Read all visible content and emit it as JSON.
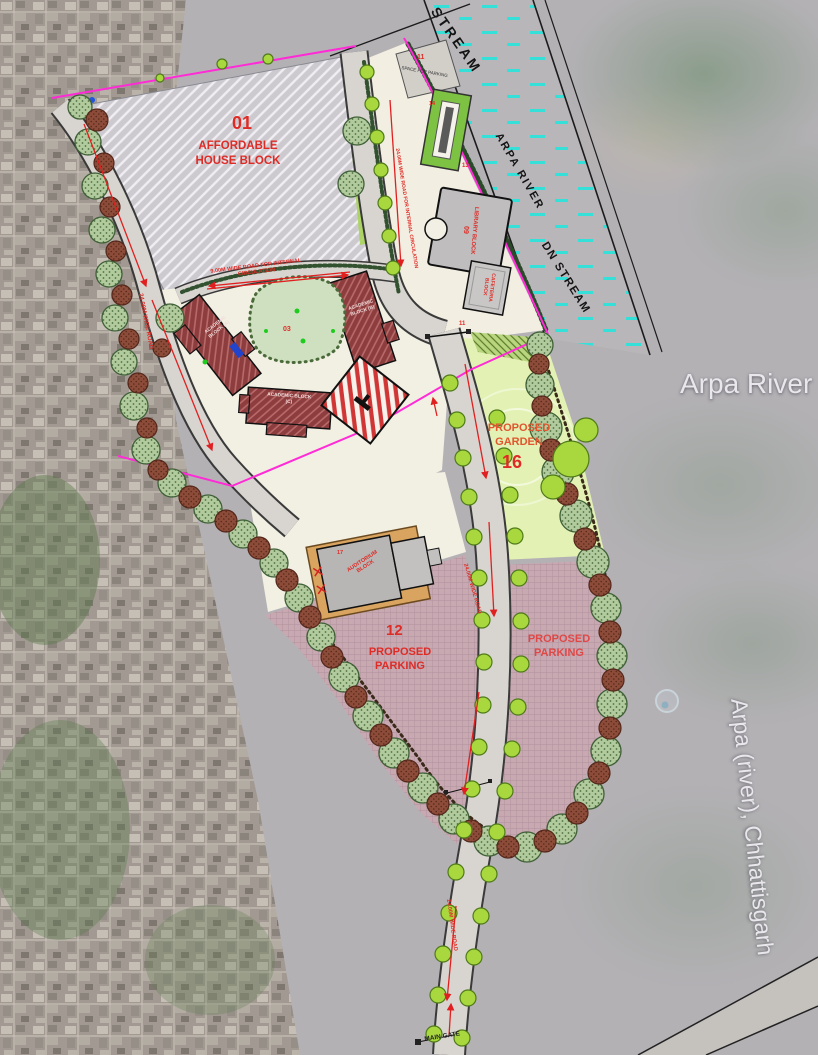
{
  "water": {
    "up_stream": "STREAM",
    "arpa_river": "ARPA RIVER",
    "dn_stream": "DN STREAM"
  },
  "map": {
    "river_name": "Arpa River",
    "river_full_name": "Arpa (river), Chhattisgarh"
  },
  "zones": {
    "affordable": {
      "number": "01",
      "label": "AFFORDABLE HOUSE BLOCK"
    },
    "space_for_parking": {
      "number": "11",
      "label": "SPACE FOR PARKING"
    },
    "plaza": {
      "number": "13"
    },
    "pool": {
      "number": "14"
    },
    "courtyard": {
      "number": "03"
    },
    "junction": {
      "number": "11"
    },
    "garden": {
      "number": "16",
      "label": "PROPOSED GARDEN"
    },
    "parking_west": {
      "number": "12",
      "label": "PROPOSED PARKING"
    },
    "parking_east": {
      "label": "PROPOSED PARKING"
    }
  },
  "buildings": {
    "library": {
      "label": "LIBRARY BLOCK",
      "number": "09"
    },
    "cafeteria": {
      "label": "CAFETERIA BLOCK"
    },
    "academic_a": {
      "label": "ACADEMIC BLOCK (A)"
    },
    "academic_b": {
      "label": "ACADEMIC BLOCK (B)"
    },
    "academic_c": {
      "label": "ACADEMIC BLOCK (C)"
    },
    "auditorium": {
      "number": "17",
      "label": "AUDITORIUM BLOCK"
    }
  },
  "roads": {
    "internal_9m": "9.00M WIDE ROAD FOR INTERNAL CIRCULATION",
    "west_24m": "24.00M WIDE ROAD",
    "riverside_24m": "24.00M WIDE ROAD FOR INTERNAL CIRCULATION",
    "main_24m": "24.00M WIDE ROAD",
    "south_24m": "24.00M WIDE ROAD",
    "main_gate": "MAIN GATE"
  },
  "colors": {
    "boundary": "#ff2bd6",
    "label_red": "#df2b26",
    "water_dash": "#35e0d8",
    "garden_text": "#e2552f"
  }
}
